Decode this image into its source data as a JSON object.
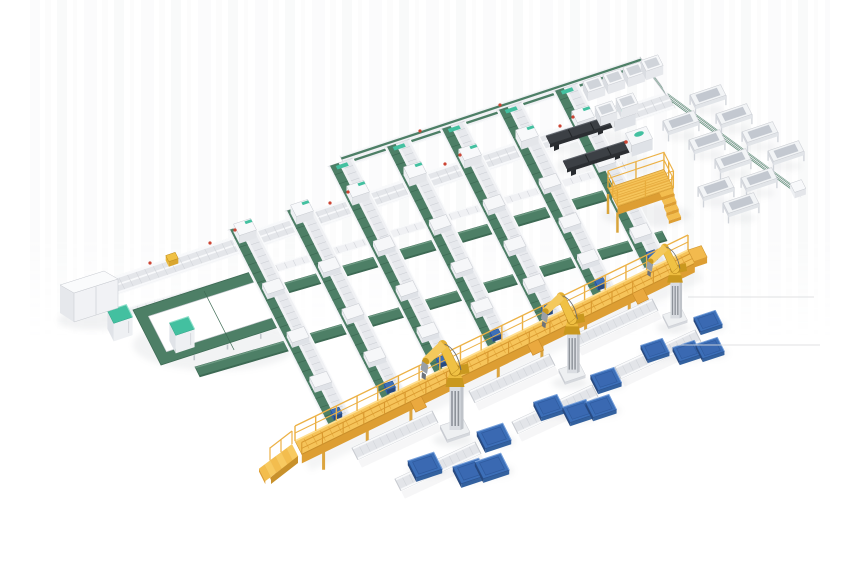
{
  "image": {
    "width": 860,
    "height": 580,
    "background": "#ffffff",
    "kind": "isometric 3D render of automated conveyor sorting and robotic palletizing system"
  },
  "palette": {
    "belt_green": "#4d7f66",
    "belt_green_dark": "#3d6a54",
    "belt_green_light": "#6d9a83",
    "frame_white": "#f0f1f4",
    "frame_mid": "#e4e6ea",
    "frame_edge": "#c7cad0",
    "frame_shadow": "#d5d8dd",
    "walkway_yellow": "#f6c45a",
    "walkway_yellow_dark": "#dd9e33",
    "walkway_yellow_deep": "#c8912b",
    "walkway_yellow_light": "#ffe093",
    "robot_yellow": "#f0c144",
    "robot_yellow_dark": "#c9981f",
    "pallet_blue": "#3c6fb8",
    "pallet_blue_mid": "#33619f",
    "pallet_blue_dark": "#27497f",
    "pallet_blue_hi": "#7aa3dd",
    "machine_dark": "#3c4045",
    "machine_dark_side": "#2b2e32",
    "teal_accent": "#43c0a0",
    "red_accent": "#cc4433",
    "blue_accent": "#2f5fae",
    "shadow": "#9aa0a8",
    "artifact_gray": "#dcdddf"
  },
  "scene": {
    "artifact_lines": [
      [
        688,
        297,
        814,
        297
      ],
      [
        676,
        345,
        820,
        345
      ]
    ],
    "main_line": {
      "p1": [
        75,
        290
      ],
      "p2": [
        667,
        92
      ],
      "w": 18
    },
    "trunk_line": {
      "p1": [
        340,
        156
      ],
      "p2": [
        640,
        57
      ],
      "w": 12
    },
    "connector": {
      "p1": [
        640,
        57
      ],
      "p2": [
        661,
        85
      ],
      "w": 12
    },
    "branch_line": {
      "p1": [
        667,
        92
      ],
      "p2": [
        795,
        186
      ],
      "w": 13
    },
    "collect_line": {
      "p1": [
        128,
        308
      ],
      "p2": [
        622,
        162
      ],
      "w": 8
    },
    "wide_belts": [
      {
        "p1": [
          150,
          322
        ],
        "p2": [
          660,
          174
        ],
        "w": 11
      },
      {
        "p1": [
          195,
          367
        ],
        "p2": [
          662,
          231
        ],
        "w": 11
      }
    ],
    "loop": {
      "outer": [
        [
          133,
          310
        ],
        [
          266,
          267
        ],
        [
          294,
          322
        ],
        [
          161,
          365
        ]
      ],
      "inset": 11,
      "rung": {
        "p1": [
          204,
          291
        ],
        "p2": [
          230,
          342
        ],
        "w": 9
      }
    },
    "lanes": [
      {
        "head": [
          245,
          235
        ],
        "stub": 10,
        "len": 210,
        "red": true
      },
      {
        "head": [
          302,
          216
        ],
        "stub": 10,
        "len": 202,
        "red": false
      },
      {
        "head": [
          358,
          197
        ],
        "stub": 39,
        "len": 194,
        "red": true
      },
      {
        "head": [
          415,
          178
        ],
        "stub": 39,
        "len": 186,
        "red": false
      },
      {
        "head": [
          470,
          160
        ],
        "stub": 39,
        "len": 178,
        "red": true
      },
      {
        "head": [
          527,
          141
        ],
        "stub": 39,
        "len": 170,
        "red": false
      },
      {
        "head": [
          583,
          122
        ],
        "stub": 39,
        "len": 160,
        "red": true
      }
    ],
    "walkway": {
      "p1": [
        295,
        441
      ],
      "p2": [
        688,
        250
      ],
      "w": 15
    },
    "discharge_stubs": [
      {
        "p1": [
          352,
          448
        ],
        "p2": [
          432,
          411
        ]
      },
      {
        "p1": [
          395,
          479
        ],
        "p2": [
          475,
          442
        ]
      },
      {
        "p1": [
          469,
          391
        ],
        "p2": [
          549,
          354
        ]
      },
      {
        "p1": [
          512,
          422
        ],
        "p2": [
          592,
          385
        ]
      },
      {
        "p1": [
          572,
          336
        ],
        "p2": [
          652,
          299
        ]
      },
      {
        "p1": [
          615,
          367
        ],
        "p2": [
          695,
          330
        ]
      }
    ],
    "robots": [
      {
        "pos": [
          455,
          432
        ],
        "scale": 1.0
      },
      {
        "pos": [
          572,
          375
        ],
        "scale": 0.9
      },
      {
        "pos": [
          675,
          320
        ],
        "scale": 0.83
      }
    ],
    "pallets": [
      {
        "pos": [
          425,
          465
        ],
        "scale": 1.05
      },
      {
        "pos": [
          470,
          471
        ],
        "scale": 1.05
      },
      {
        "pos": [
          492,
          466
        ],
        "scale": 1.05
      },
      {
        "pos": [
          494,
          436
        ],
        "scale": 1.05
      },
      {
        "pos": [
          549,
          406
        ],
        "scale": 0.95
      },
      {
        "pos": [
          578,
          411
        ],
        "scale": 0.95
      },
      {
        "pos": [
          601,
          406
        ],
        "scale": 0.95
      },
      {
        "pos": [
          606,
          379
        ],
        "scale": 0.95
      },
      {
        "pos": [
          655,
          349
        ],
        "scale": 0.88
      },
      {
        "pos": [
          687,
          351
        ],
        "scale": 0.88
      },
      {
        "pos": [
          710,
          348
        ],
        "scale": 0.88
      },
      {
        "pos": [
          708,
          321
        ],
        "scale": 0.88
      }
    ],
    "troughs": [
      [
        708,
        104
      ],
      [
        734,
        123
      ],
      [
        760,
        141
      ],
      [
        786,
        160
      ],
      [
        681,
        130
      ],
      [
        707,
        149
      ],
      [
        733,
        168
      ],
      [
        759,
        187
      ],
      [
        716,
        196
      ],
      [
        741,
        212
      ]
    ],
    "bins": [
      [
        594,
        93
      ],
      [
        614,
        86
      ],
      [
        634,
        79
      ],
      [
        652,
        72
      ],
      [
        606,
        118
      ],
      [
        627,
        110
      ]
    ],
    "cabinets": [
      [
        120,
        332
      ],
      [
        182,
        344
      ]
    ],
    "infeed_box": {
      "origin": [
        60,
        284
      ]
    },
    "dock_machines": [
      [
        546,
        136
      ],
      [
        563,
        161
      ]
    ],
    "platform": {
      "nw": [
        608,
        188
      ],
      "a": 59,
      "b": 21,
      "rail": 17,
      "height": 8,
      "legs": 26
    },
    "line_items": {
      "yellow_box": [
        172,
        262
      ],
      "red_dots": [
        [
          150,
          263
        ],
        [
          210,
          243
        ],
        [
          330,
          203
        ],
        [
          445,
          164
        ],
        [
          560,
          126
        ],
        [
          420,
          131
        ],
        [
          500,
          105
        ]
      ]
    }
  }
}
